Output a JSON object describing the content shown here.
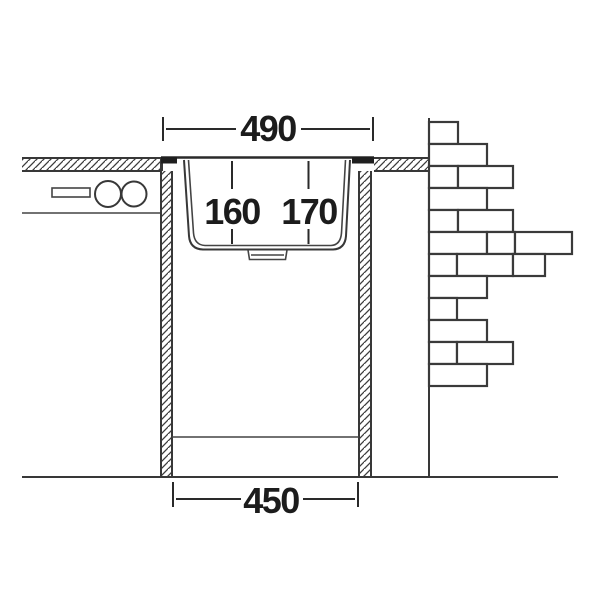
{
  "drawing": {
    "type": "sink-installation-cross-section",
    "line_color": "#383838",
    "text_color": "#1c1c1c",
    "background": "#ffffff",
    "dimensions": {
      "top_width": "490",
      "bottom_width": "450",
      "depth_left": "160",
      "depth_right": "170"
    }
  }
}
